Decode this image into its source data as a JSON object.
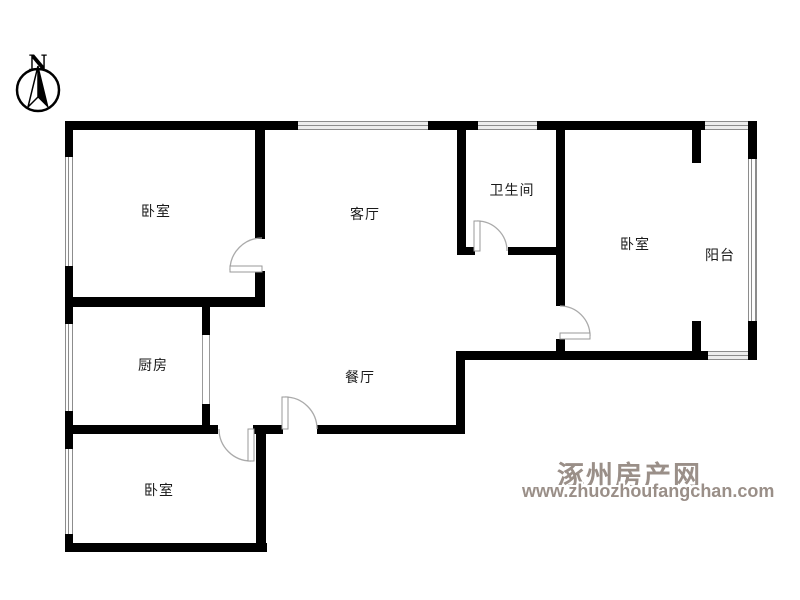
{
  "title": "apartment-floor-plan",
  "compass": {
    "label": "N"
  },
  "rooms": [
    {
      "name": "bedroom-top-left",
      "label": "卧室"
    },
    {
      "name": "living-room",
      "label": "客厅"
    },
    {
      "name": "bathroom",
      "label": "卫生间"
    },
    {
      "name": "bedroom-right",
      "label": "卧室"
    },
    {
      "name": "balcony",
      "label": "阳台"
    },
    {
      "name": "kitchen",
      "label": "厨房"
    },
    {
      "name": "dining-room",
      "label": "餐厅"
    },
    {
      "name": "bedroom-bottom",
      "label": "卧室"
    }
  ],
  "watermark": {
    "site_name": "涿州房产网",
    "site_url": "www.zhuozhoufangchan.com",
    "color": "#9a8f88"
  },
  "colors": {
    "wall": "#000000",
    "door_arc": "#aaaaaa",
    "window_line": "#8c8c8c",
    "background": "#ffffff"
  }
}
